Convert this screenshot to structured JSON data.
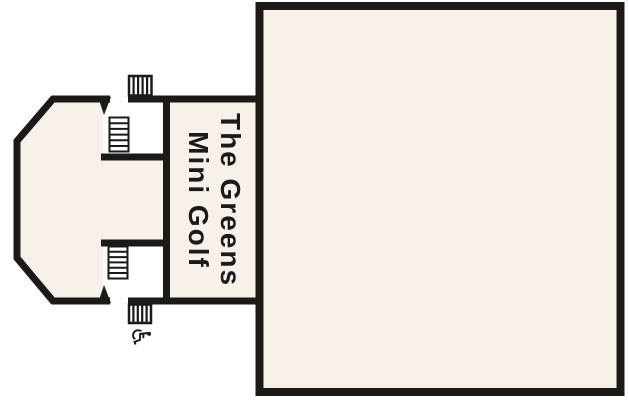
{
  "figure": {
    "type": "cruise-deck-plan-section",
    "venue_label": {
      "line1": "The Greens",
      "line2": "Mini Golf"
    },
    "icons": {
      "wheelchair_glyph": "♿",
      "names": [
        "stairs-icon",
        "stairs-icon",
        "deck-hatch-icon",
        "deck-hatch-icon",
        "wheelchair-accessible-icon",
        "door-swing-mark",
        "door-swing-mark"
      ]
    },
    "colors": {
      "background": "#FFFFFF",
      "deck_fill": "#F8F1EA",
      "outline_ink": "#1B1A17",
      "label_text": "#1A1A1A"
    }
  }
}
